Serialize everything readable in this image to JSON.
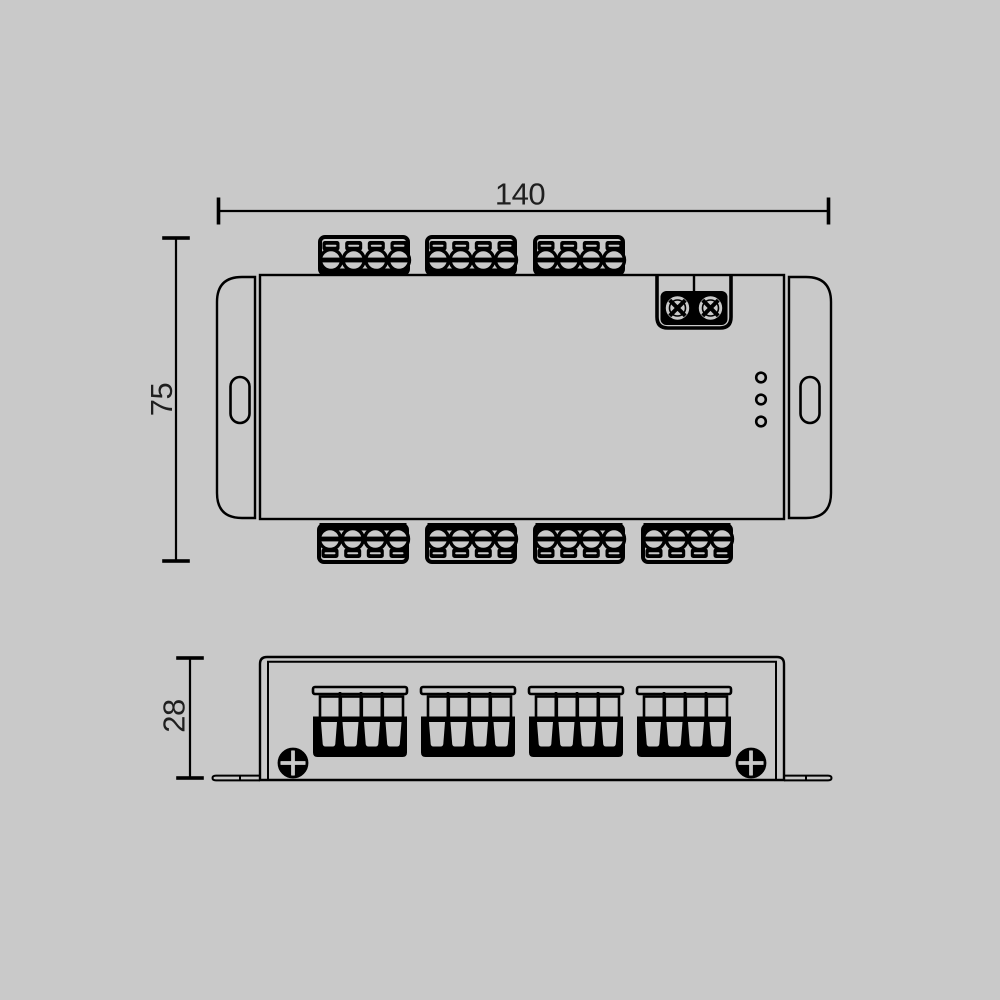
{
  "drawing": {
    "dims": {
      "width": "140",
      "height": "75",
      "depth": "28"
    },
    "colors": {
      "background": "#c9c9c9",
      "line": "#000000",
      "text": "#1f1f1f"
    },
    "top_view": {
      "terminal_blocks_top": 3,
      "terminal_blocks_bottom": 4,
      "power_terminal_screws": 2,
      "indicator_leds": 3,
      "mounting_slots": 2
    },
    "front_view": {
      "terminal_blocks": 4,
      "chassis_screws": 2,
      "mounting_feet": 2
    }
  }
}
